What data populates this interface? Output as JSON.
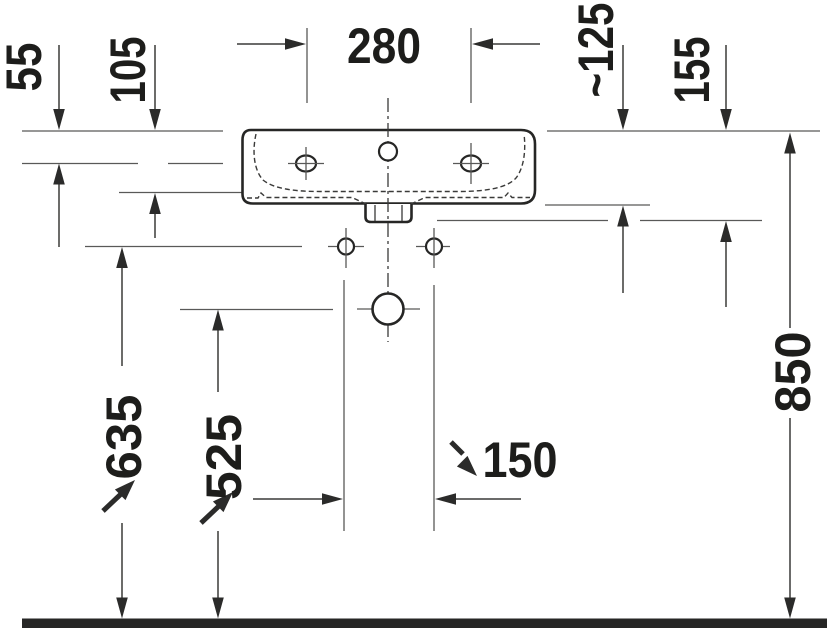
{
  "drawing": {
    "subject": "washbasin-front-elevation-technical-drawing",
    "colors": {
      "background": "#ffffff",
      "outline": "#262625",
      "dimension_line": "#3a3a39",
      "reference_line": "#595958",
      "text": "#1d1d1b",
      "floor": "#262625"
    },
    "dimensions": {
      "faucet_hole_spacing": "280",
      "rim_to_faucet_center": "55",
      "rim_to_basin_ledge": "105",
      "rim_to_underside": "~125",
      "front_height": "155",
      "floor_to_rim": "850",
      "floor_to_fixing_holes": "635",
      "floor_to_drain_center": "525",
      "drain_to_fixing_offset": "150"
    }
  }
}
